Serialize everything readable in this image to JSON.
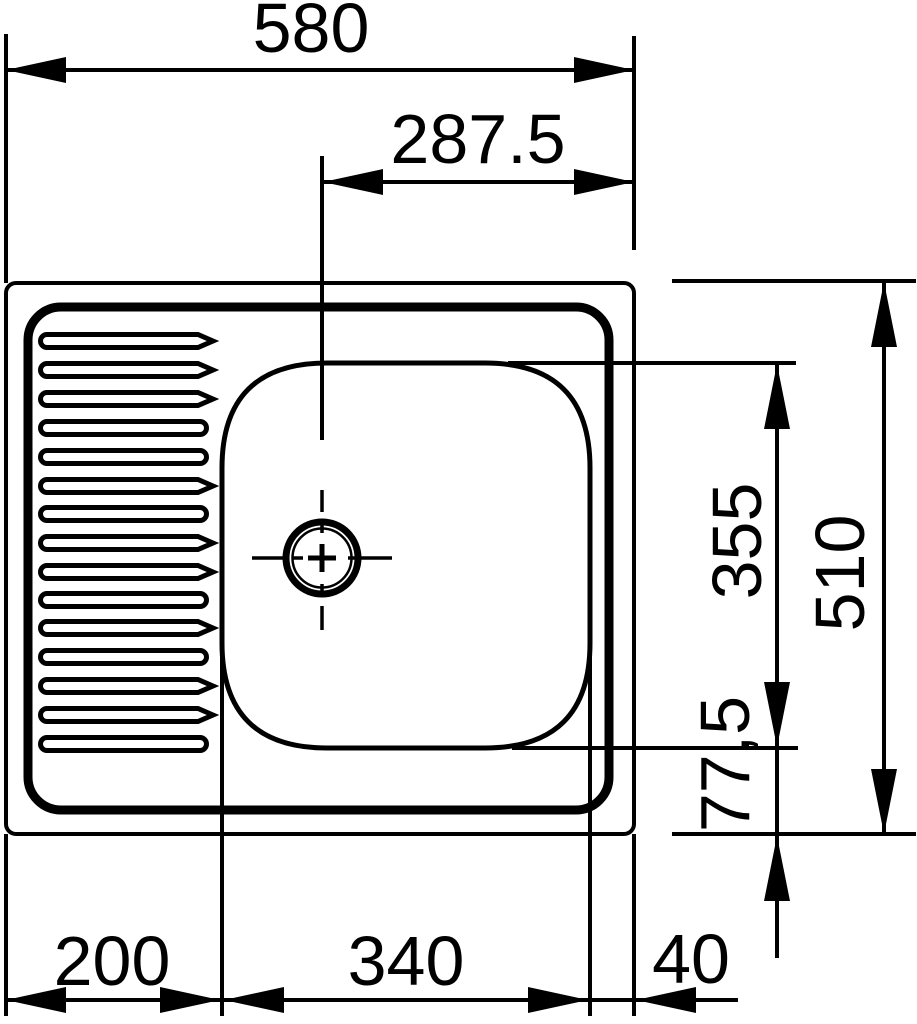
{
  "drawing": {
    "subject": "Kitchen sink plan-view technical drawing with left drainboard and right bowl",
    "view": "top",
    "line_color": "#000000",
    "background_color": "#ffffff",
    "dimensions": {
      "overall_width": "580",
      "drain_center_to_right_edge": "287.5",
      "bowl_length": "355",
      "overall_depth": "510",
      "bowl_to_bottom_edge": "77,5",
      "drainboard_width": "200",
      "bowl_width": "340",
      "right_margin": "40"
    }
  }
}
